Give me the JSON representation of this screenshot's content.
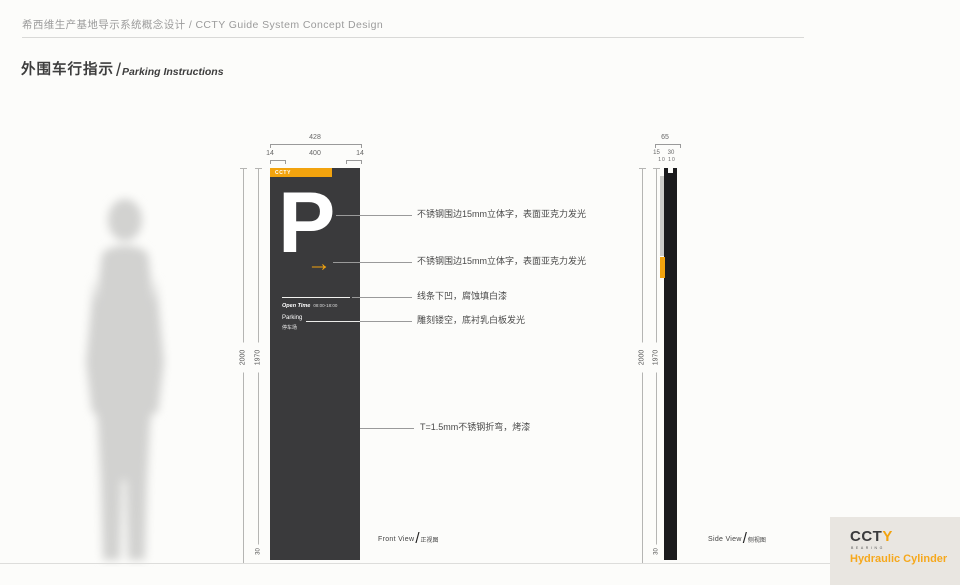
{
  "header": {
    "project_title": "希西维生产基地导示系统概念设计 / CCTY Guide System Concept Design"
  },
  "section": {
    "title_zh": "外围车行指示",
    "slash": "/",
    "title_en": "Parking Instructions"
  },
  "front": {
    "dims": {
      "w_total": "428",
      "w_left": "14",
      "w_center": "400",
      "w_right": "14",
      "h_total": "2000",
      "h_panel": "1970",
      "h_base": "30"
    },
    "sign": {
      "brand": "CCTY",
      "letter": "P",
      "arrow": "→",
      "open_time_label": "Open Time",
      "open_time_value": "08:00-18:00",
      "parking_en": "Parking",
      "parking_zh": "停车场"
    },
    "view_label": {
      "en": "Front View",
      "slash": "/",
      "zh": "正视图"
    }
  },
  "side": {
    "dims": {
      "d_total": "65",
      "d_front": "15",
      "d_mid": "30",
      "d_back": "10 10",
      "h_total": "2000",
      "h_panel": "1970",
      "h_base": "30"
    },
    "view_label": {
      "en": "Side View",
      "slash": "/",
      "zh": "侧视图"
    }
  },
  "annotations": [
    "不锈钢围边15mm立体字，表面亚克力发光",
    "不锈钢围边15mm立体字，表面亚克力发光",
    "线条下凹，腐蚀填白漆",
    "雕刻镂空，底衬乳白板发光",
    "T=1.5mm不锈钢折弯，烤漆"
  ],
  "footer": {
    "logo_cct": "CCT",
    "logo_y": "Y",
    "logo_sub": "BEARING",
    "tagline": "Hydraulic Cylinder"
  },
  "colors": {
    "accent": "#F2A30E",
    "sign_body": "#3A3A3C",
    "side_profile": "#1B1B1D",
    "silhouette": "#D2D2D0"
  }
}
